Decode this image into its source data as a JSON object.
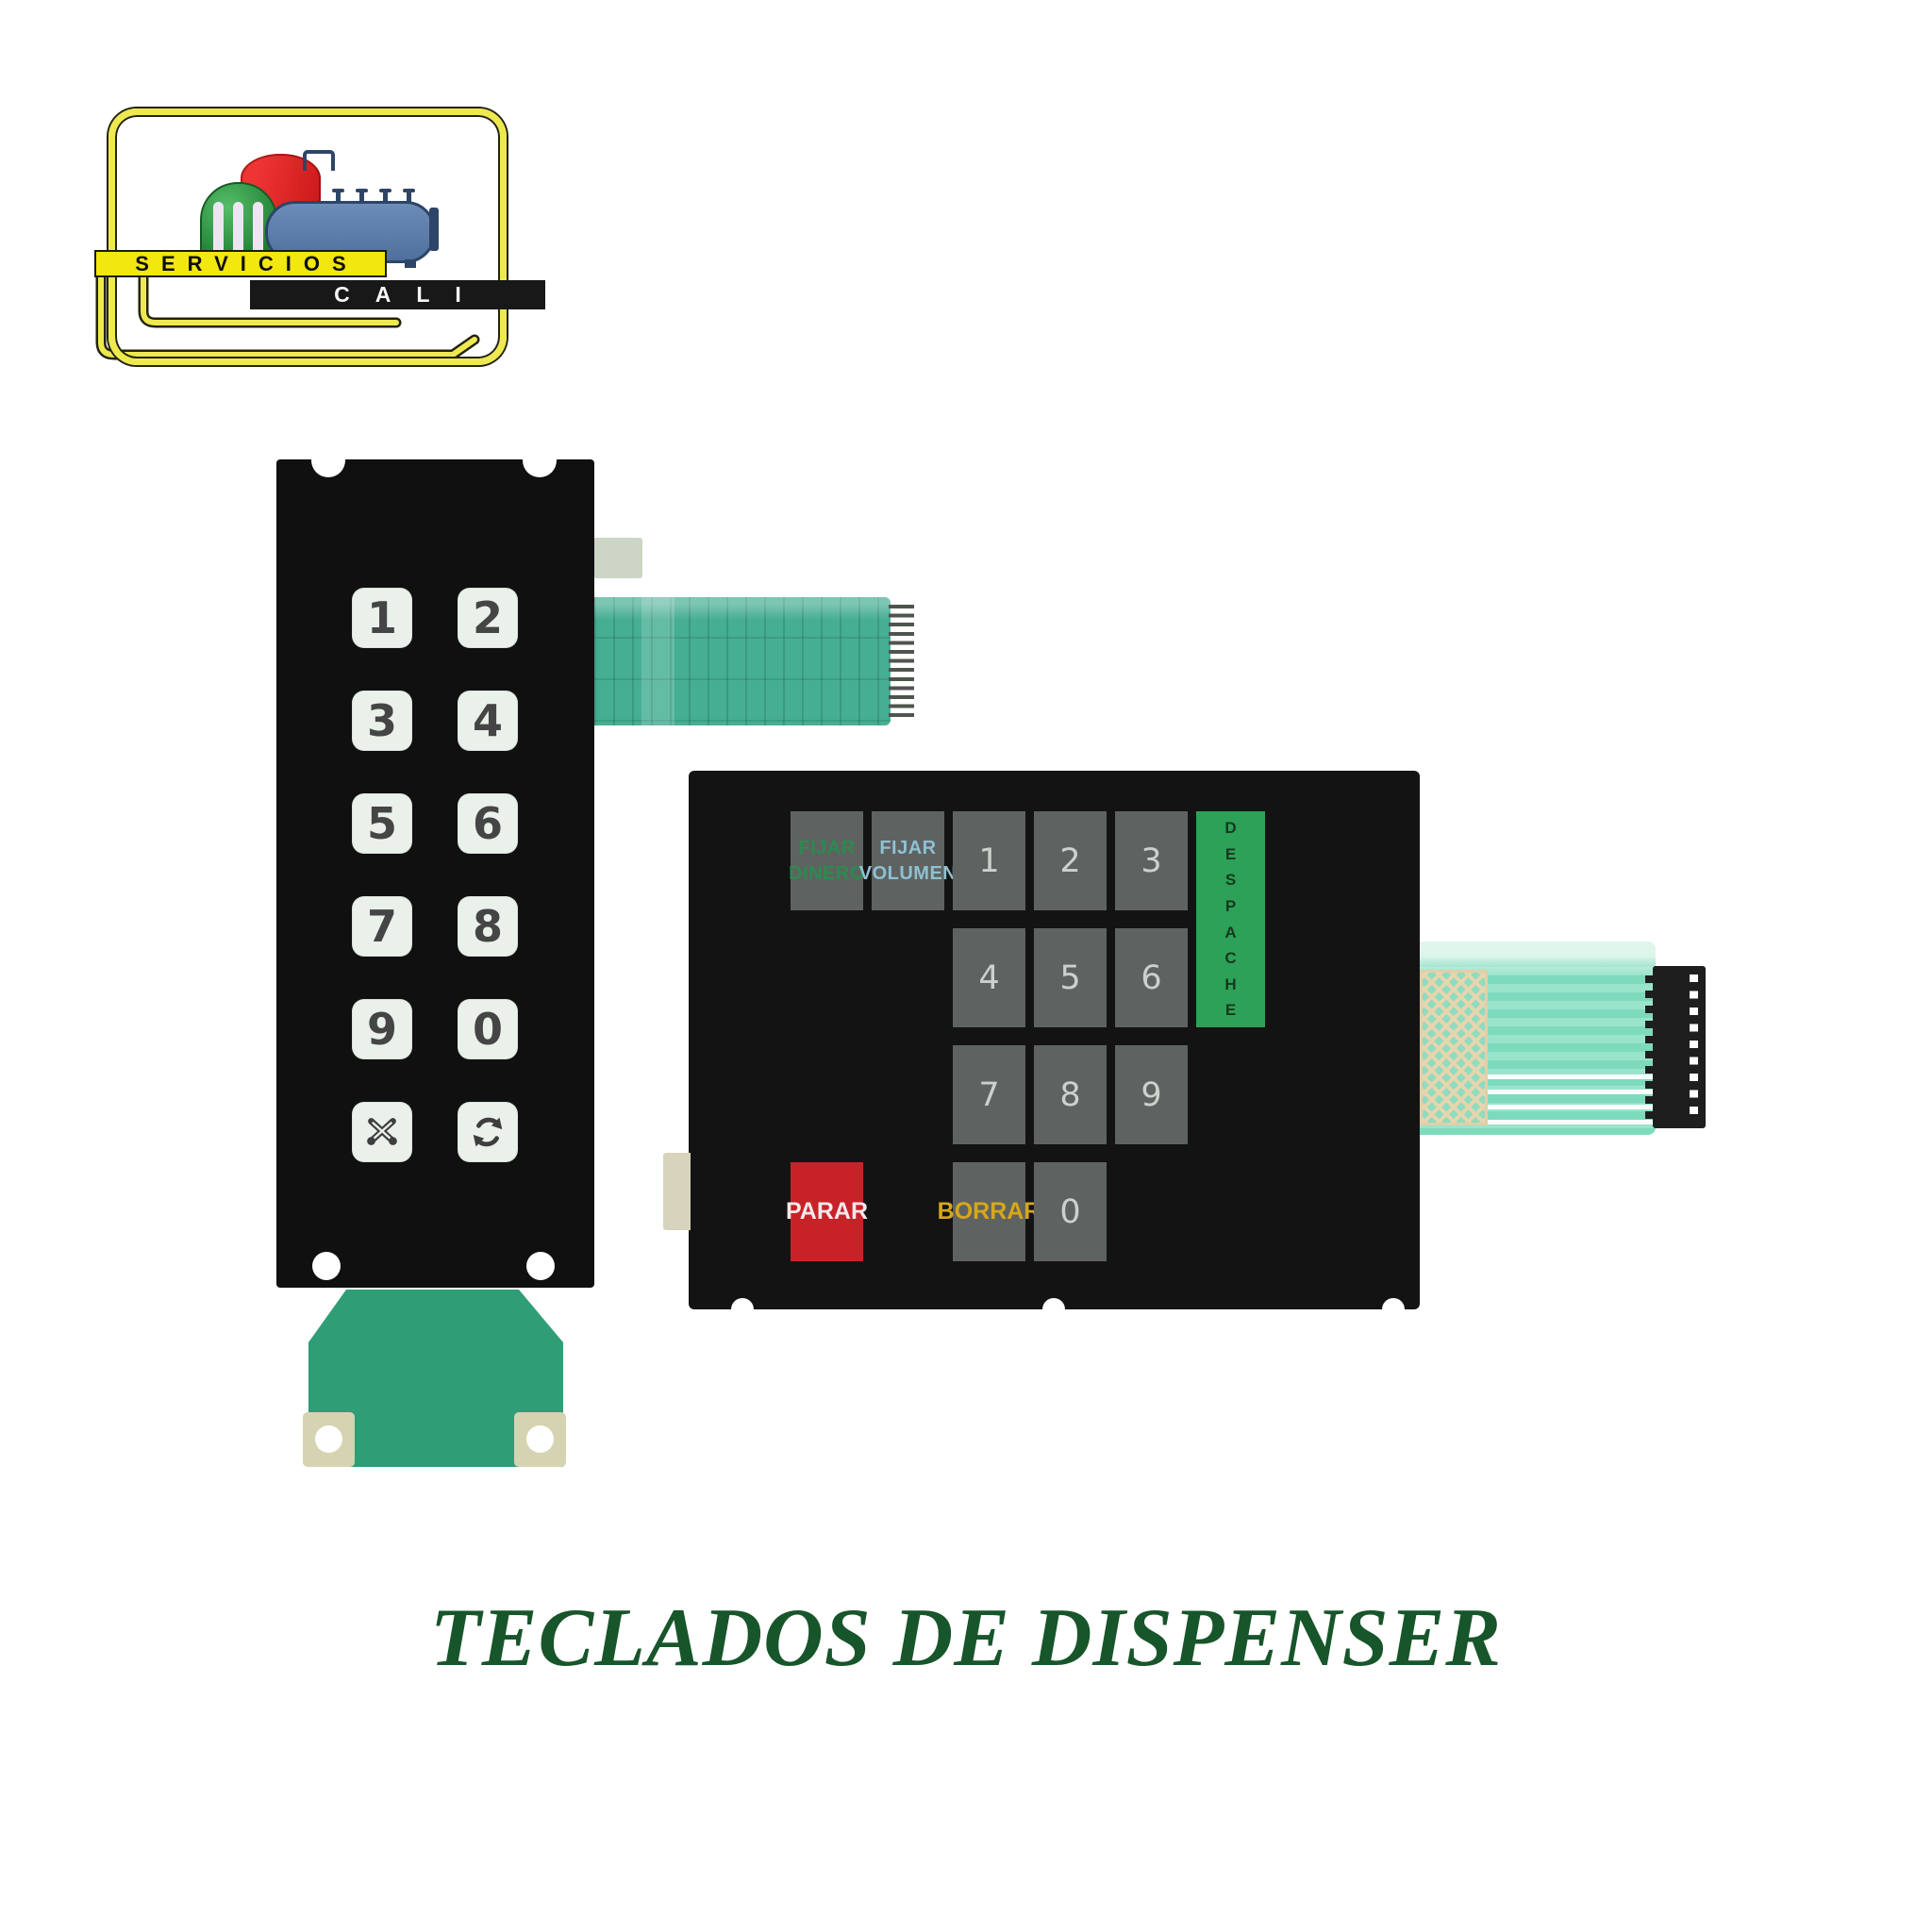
{
  "logo": {
    "line1": "SERVICIOS",
    "line2": "CALI",
    "graphic": "storage-tanks-and-tanker-illustration",
    "colors": {
      "banner_yellow": "#f2e70e",
      "banner_black": "#181818",
      "frame_yellow": "#eee94f",
      "tank_green": "#2c9440",
      "tank_red": "#da2020",
      "tanker_blue": "#5b7bab"
    }
  },
  "left_keypad": {
    "description": "Vertical 12-key dispenser membrane keypad",
    "keys": [
      {
        "label": "1"
      },
      {
        "label": "2"
      },
      {
        "label": "3"
      },
      {
        "label": "4"
      },
      {
        "label": "5"
      },
      {
        "label": "6"
      },
      {
        "label": "7"
      },
      {
        "label": "8"
      },
      {
        "label": "9"
      },
      {
        "label": "0"
      },
      {
        "icon": "crossed-pencils-icon"
      },
      {
        "icon": "cycle-arrows-icon"
      }
    ],
    "colors": {
      "panel": "#101010",
      "key": "#e9f1ea",
      "digit": "#454545",
      "ribbon": "#46ae93",
      "tail": "#2f9e77"
    }
  },
  "right_keypad": {
    "description": "Dispenser preset membrane keypad",
    "keys": [
      {
        "label": "FIJAR DINERO",
        "lines": [
          "FIJAR",
          "DINERO"
        ],
        "col": 1,
        "row": 1,
        "text_color": "#2c8a4e"
      },
      {
        "label": "FIJAR VOLUMEN",
        "lines": [
          "FIJAR",
          "VOLUMEN"
        ],
        "col": 2,
        "row": 1,
        "text_color": "#8fc0d2"
      },
      {
        "label": "1",
        "col": 3,
        "row": 1
      },
      {
        "label": "2",
        "col": 4,
        "row": 1
      },
      {
        "label": "3",
        "col": 5,
        "row": 1
      },
      {
        "label": "DESPACHE",
        "col": 6,
        "row": 1,
        "rowspan": 2,
        "vertical": true,
        "bg": "#2da157",
        "text_color": "#14391d"
      },
      {
        "label": "4",
        "col": 3,
        "row": 2
      },
      {
        "label": "5",
        "col": 4,
        "row": 2
      },
      {
        "label": "6",
        "col": 5,
        "row": 2
      },
      {
        "label": "7",
        "col": 3,
        "row": 3
      },
      {
        "label": "8",
        "col": 4,
        "row": 3
      },
      {
        "label": "9",
        "col": 5,
        "row": 3
      },
      {
        "label": "PARAR",
        "col": 1,
        "row": 4,
        "bg": "#c82229",
        "text_color": "#f2e9e8"
      },
      {
        "label": "BORRAR",
        "col": 3,
        "row": 4,
        "text_color": "#d7a61a"
      },
      {
        "label": "0",
        "col": 4,
        "row": 4
      }
    ],
    "colors": {
      "panel": "#131313",
      "key": "#5e6361",
      "digit": "#ccd1cd",
      "despache_green": "#2da157",
      "parar_red": "#c82229",
      "borrar_text": "#d7a61a"
    }
  },
  "caption": {
    "title": "TECLADOS DE DISPENSER",
    "color": "#17552a"
  }
}
